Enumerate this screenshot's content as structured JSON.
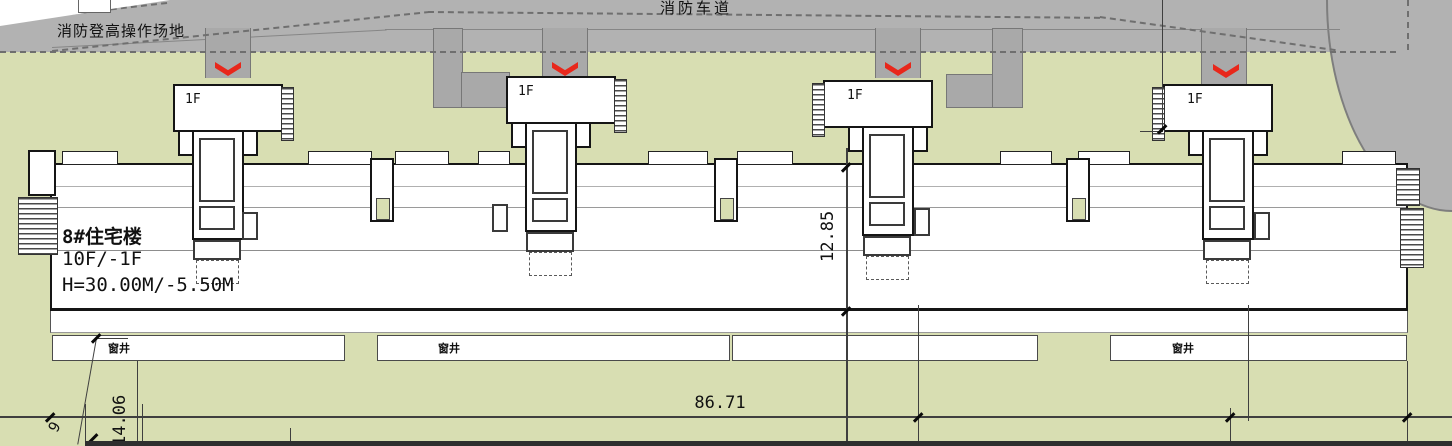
{
  "road": {
    "label": "消防车道"
  },
  "fire_zone": {
    "label": "消防登高操作场地"
  },
  "building": {
    "name": "8#住宅楼",
    "floors": "10F/-1F",
    "height": "H=30.00M/-5.50M"
  },
  "units": [
    {
      "label": "1F"
    },
    {
      "label": "1F"
    },
    {
      "label": "1F"
    },
    {
      "label": "1F"
    }
  ],
  "wells": {
    "label_left": "窗井",
    "label_mid": "窗井",
    "label_right": "窗井"
  },
  "dims": {
    "overall_width": "86.71",
    "building_depth": "12.85",
    "front_setback": "14.06",
    "partial": "9"
  },
  "colors": {
    "ground": "#d8deb2",
    "road": "#b2b2b2",
    "path": "#a9a9a9",
    "marker": "#e8271b"
  }
}
